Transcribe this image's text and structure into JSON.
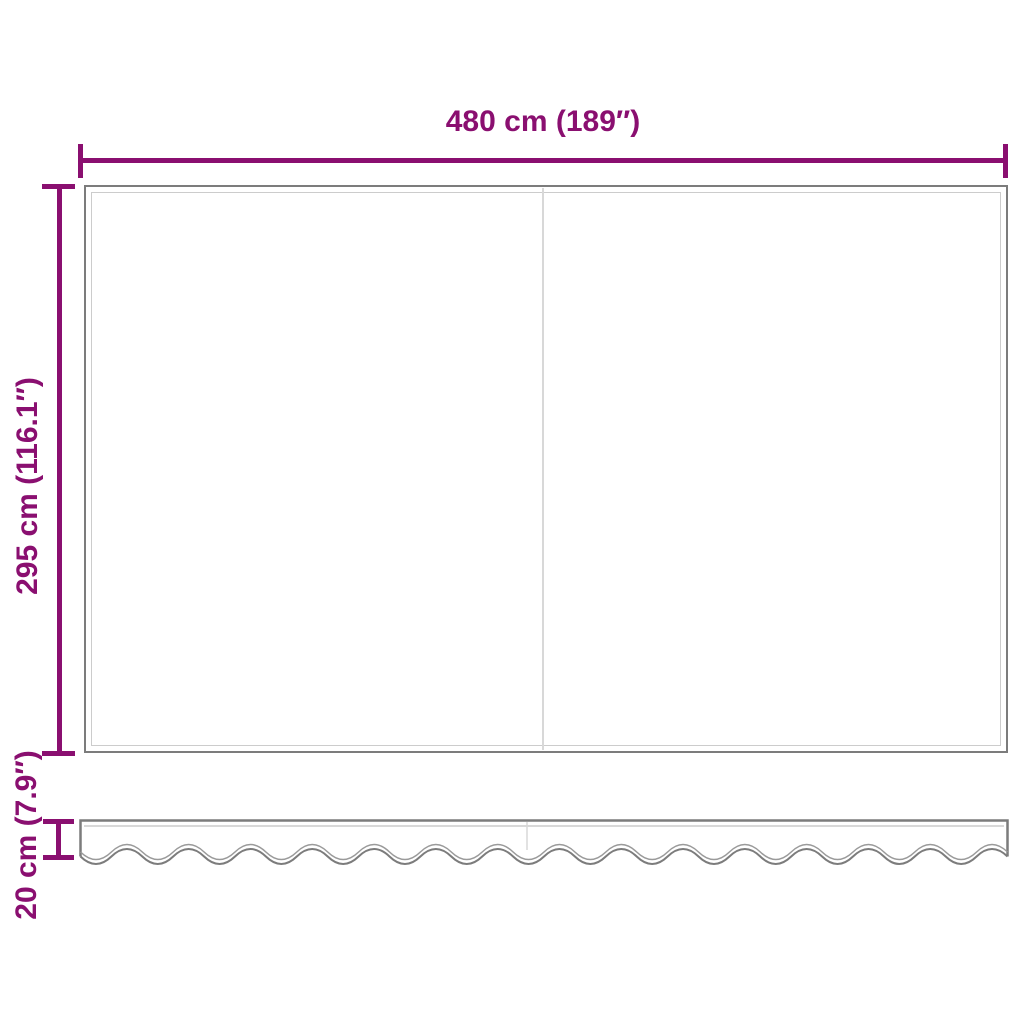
{
  "diagram": {
    "type": "product-dimension-drawing",
    "subject": "replacement awning fabric with wavy valance strip"
  },
  "panel": {
    "width_label": "480 cm (189″)",
    "height_label": "295 cm (116.1″)"
  },
  "valance": {
    "height_label": "20 cm (7.9″)"
  },
  "colors": {
    "dimension_accent": "#8a0f70",
    "fabric_outline": "#7c7c7c",
    "fabric_inner_line": "#cccccc",
    "seam": "#d8d8d8",
    "background": "#ffffff"
  }
}
